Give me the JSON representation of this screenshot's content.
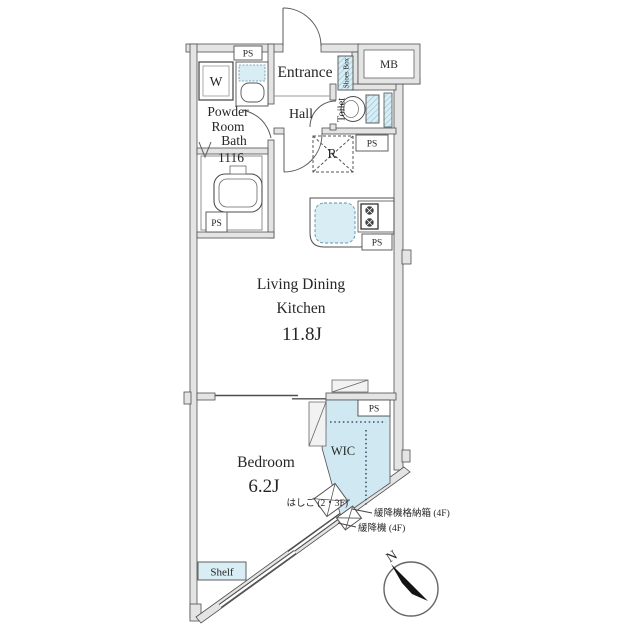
{
  "plan": {
    "rooms": {
      "entrance": "Entrance",
      "hall": "Hall",
      "powder_room": [
        "Powder",
        "Room"
      ],
      "toilet": "Toilet",
      "bath": [
        "Bath",
        "1116"
      ],
      "ldk": {
        "name": [
          "Living Dining",
          "Kitchen"
        ],
        "size": "11.8J"
      },
      "bedroom": {
        "name": "Bedroom",
        "size": "6.2J"
      },
      "wic": "WIC"
    },
    "fixtures": {
      "washing_machine": "W",
      "shoes_box": "Shoes Box",
      "meter_box": "MB",
      "pipe_space": "PS",
      "refrigerator": "R",
      "shelf": "Shelf"
    },
    "annotations": {
      "ladder": "はしご (2・3F)",
      "escape_device_box": "緩降機格納箱 (4F)",
      "escape_device": "緩降機 (4F)",
      "compass_north": "N"
    },
    "colors": {
      "wall_fill": "#e4e4e4",
      "wall_line": "#4f4f4f",
      "fixture_blue": "#d8edf4",
      "wic_blue": "#cfe8f2",
      "text": "#262626"
    }
  }
}
